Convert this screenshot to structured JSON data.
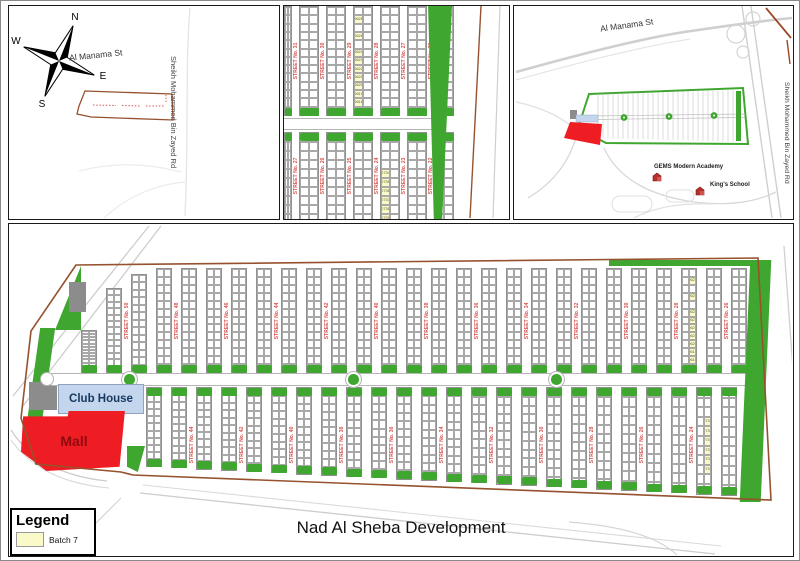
{
  "page": {
    "title": "Nad Al Sheba Development"
  },
  "legend": {
    "title": "Legend",
    "batch_label": "Batch 7"
  },
  "labels": {
    "club_house": "Club House",
    "mall": "Mall",
    "al_manama": "Al Manama St",
    "smbz_road": "Sheikh Mohammed Bin Zayed Rd",
    "gems": "GEMS Modern Academy",
    "kings": "King's School"
  },
  "compass": {
    "n": "N",
    "e": "E",
    "s": "S",
    "w": "W"
  },
  "streets": {
    "main_upper": [
      "STREET No. 50",
      "STREET No. 48",
      "STREET No. 46",
      "STREET No. 44",
      "STREET No. 42",
      "STREET No. 40",
      "STREET No. 38",
      "STREET No. 36",
      "STREET No. 34",
      "STREET No. 32",
      "STREET No. 30",
      "STREET No. 28",
      "STREET No. 26"
    ],
    "main_lower": [
      "STREET No. 44",
      "STREET No. 42",
      "STREET No. 40",
      "STREET No. 38",
      "STREET No. 36",
      "STREET No. 34",
      "STREET No. 32",
      "STREET No. 30",
      "STREET No. 28",
      "STREET No. 26",
      "STREET No. 24",
      "STREET No. 22"
    ],
    "mid_upper": [
      "STREET No. 31",
      "STREET No. 30",
      "STREET No. 29",
      "STREET No. 28",
      "STREET No. 27",
      "STREET No. 26"
    ],
    "mid_lower": [
      "STREET No. 27",
      "STREET No. 26",
      "STREET No. 25",
      "STREET No. 24",
      "STREET No. 23",
      "STREET No. 22"
    ]
  },
  "plots": {
    "upper_batch": [
      "0628",
      "",
      "0626",
      "",
      "0624",
      "0623",
      "0622",
      "0621",
      "0620",
      "0619",
      "0618",
      "0617"
    ],
    "lower_batch": [
      "0734",
      "0735",
      "0736",
      "0737",
      "0738",
      "0739"
    ]
  },
  "colors": {
    "green": "#3FA72F",
    "mall_red": "#EE1C23",
    "mall_text": "#8f0b0f",
    "club_blue": "#C3D6EE",
    "street_red": "#D9534F",
    "boundary": "#96522E",
    "batch_yellow": "#FAFAC8",
    "road_gray": "#c9c9c9"
  }
}
